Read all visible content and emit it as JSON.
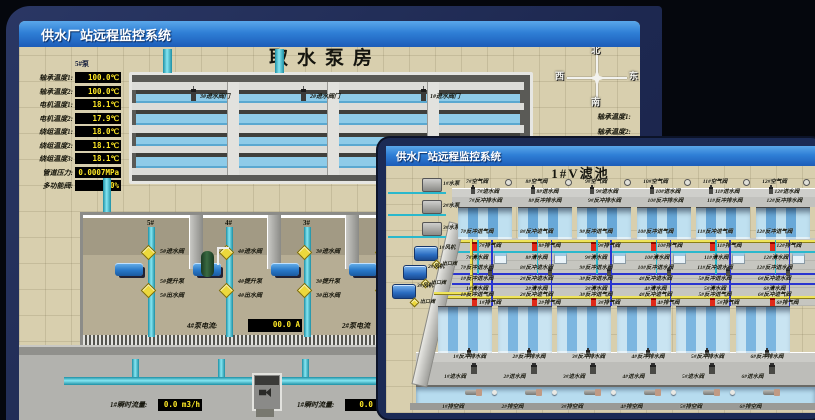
{
  "back_window": {
    "title": "供水厂站远程监控系统",
    "scene_title": "取水泵房",
    "pump_panel": {
      "pump_label": "5#泵",
      "rows": [
        {
          "label": "轴承温度1:",
          "value": "100.0℃"
        },
        {
          "label": "轴承温度2:",
          "value": "100.0℃"
        },
        {
          "label": "电机温度1:",
          "value": "18.1℃"
        },
        {
          "label": "电机温度2:",
          "value": "17.9℃"
        },
        {
          "label": "绕组温度1:",
          "value": "18.0℃"
        },
        {
          "label": "绕组温度2:",
          "value": "18.1℃"
        },
        {
          "label": "绕组温度3:",
          "value": "18.1℃"
        },
        {
          "label": "管道压力:",
          "value": "0.0007MPa"
        },
        {
          "label": "多功能阀:",
          "value": "0%"
        }
      ]
    },
    "inlet_gates": [
      "3#进水阀门",
      "2#进水阀门",
      "1#进水阀门"
    ],
    "compass": {
      "n": "北",
      "w": "西",
      "s": "南",
      "e": "东"
    },
    "right_panel": {
      "pump_label": "1#",
      "row1": "轴承温度1:",
      "row2": "轴承温度2:"
    },
    "pump_bays": [
      {
        "bay": "5#",
        "inlet": "5#进水阀",
        "pump": "5#提升泵",
        "outlet": "5#出水阀"
      },
      {
        "bay": "4#",
        "inlet": "4#进水阀",
        "pump": "4#提升泵",
        "outlet": "4#出水阀"
      },
      {
        "bay": "3#",
        "inlet": "3#进水阀",
        "pump": "3#提升泵",
        "outlet": "3#出水阀"
      },
      {
        "bay": "",
        "inlet": "",
        "pump": "",
        "outlet": ""
      }
    ],
    "current_readouts": [
      {
        "label": "4#泵电流:",
        "value": "00.0 A"
      },
      {
        "label": "2#泵电流",
        "value": ""
      }
    ],
    "flow_readouts": [
      {
        "label": "1#瞬时流量:",
        "value": "0.0 m3/h"
      },
      {
        "label": "1#瞬时流量:",
        "value": "0.0 m3/"
      }
    ]
  },
  "front_window": {
    "title": "供水厂站远程监控系统",
    "scene_title": "1#V滤池",
    "left_equipment": {
      "pumps": [
        "1#水泵",
        "2#水泵",
        "3#水泵"
      ],
      "blowers": [
        "1#风机",
        "2#风机",
        "3#风机"
      ],
      "blower_valve": "出口阀"
    },
    "back_row": {
      "air_valves": [
        "7#空气阀",
        "8#空气阀",
        "9#空气阀",
        "10#空气阀",
        "11#空气阀",
        "12#空气阀"
      ],
      "inlet_valves": [
        "7#进水阀",
        "8#进水阀",
        "9#进水阀",
        "10#进水阀",
        "11#进水阀",
        "12#进水阀"
      ],
      "drain_valves": [
        "7#反冲排水阀",
        "8#反冲排水阀",
        "9#反冲排水阀",
        "10#反冲排水阀",
        "11#反冲排水阀",
        "12#反冲排水阀"
      ]
    },
    "gallery_back": {
      "air_inlet": [
        "7#反冲进气阀",
        "8#反冲进气阀",
        "9#反冲进气阀",
        "10#反冲进气阀",
        "11#反冲进气阀",
        "12#反冲进气阀"
      ],
      "exhaust": [
        "7#排气阀",
        "8#排气阀",
        "9#排气阀",
        "10#排气阀",
        "11#排气阀",
        "12#排气阀"
      ],
      "clean": [
        "7#清水阀",
        "8#清水阀",
        "9#清水阀",
        "10#清水阀",
        "11#清水阀",
        "12#清水阀"
      ],
      "wash": [
        "7#反冲进水阀",
        "8#反冲进水阀",
        "9#反冲进水阀",
        "10#反冲进水阀",
        "11#反冲进水阀",
        "12#反冲进水阀"
      ]
    },
    "gallery_front": {
      "wash": [
        "1#反冲进水阀",
        "2#反冲进水阀",
        "3#反冲进水阀",
        "4#反冲进水阀",
        "5#反冲进水阀",
        "6#反冲进水阀"
      ],
      "clean": [
        "1#清水阀",
        "2#清水阀",
        "3#清水阀",
        "4#清水阀",
        "5#清水阀",
        "6#清水阀"
      ],
      "exhaust": [
        "1#排气阀",
        "2#排气阀",
        "3#排气阀",
        "4#排气阀",
        "5#排气阀",
        "6#排气阀"
      ],
      "air_inlet": [
        "1#反冲进气阀",
        "2#反冲进气阀",
        "3#反冲进气阀",
        "4#反冲进气阀",
        "5#反冲进气阀",
        "6#反冲进气阀"
      ]
    },
    "front_row": {
      "drain_valves": [
        "1#反冲排水阀",
        "2#反冲排水阀",
        "3#反冲排水阀",
        "4#反冲排水阀",
        "5#反冲排水阀",
        "6#反冲排水阀"
      ],
      "inlet_valves": [
        "1#进水阀",
        "2#进水阀",
        "3#进水阀",
        "4#进水阀",
        "5#进水阀",
        "6#进水阀"
      ],
      "empty_valves": [
        "1#排空阀",
        "2#排空阀",
        "3#排空阀",
        "4#排空阀",
        "5#排空阀",
        "6#排空阀"
      ]
    }
  },
  "colors": {
    "titlebar_blue": "#2f7fd6",
    "value_yellow": "#ffe926",
    "alarm_red": "#e02818",
    "pipe_cyan": "#35b8cc",
    "air_line_yellow": "#efe45a",
    "water_line_blue": "#2a35d0",
    "scene_beige": "#d8cfae",
    "desktop_navy": "#243059"
  }
}
